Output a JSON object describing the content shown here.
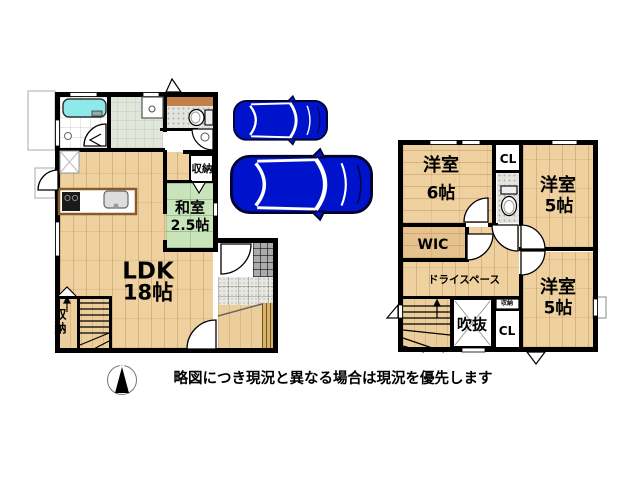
{
  "floor1": {
    "rooms": {
      "ldk": {
        "label": "LDK",
        "size": "18帖"
      },
      "washitsu": {
        "label": "和室",
        "size": "2.5帖"
      },
      "storage_east": {
        "label": "収納"
      },
      "storage_stairs": {
        "label": "収納"
      }
    }
  },
  "floor2": {
    "rooms": {
      "bedroom6": {
        "label": "洋室",
        "size": "6帖"
      },
      "bedroom5_north": {
        "label": "洋室",
        "size": "5帖"
      },
      "bedroom5_south": {
        "label": "洋室",
        "size": "5帖"
      },
      "wic": {
        "label": "WIC"
      },
      "dry_space": {
        "label": "ドライスペース"
      },
      "void": {
        "label": "吹抜"
      },
      "closet_north": {
        "label": "CL"
      },
      "closet_south": {
        "label": "CL"
      },
      "storage_small": {
        "label": "収納"
      }
    }
  },
  "compass": {
    "north": "N"
  },
  "caption": "略図につき現況と異なる場合は現況を優先します",
  "icons": {
    "car_small": "car-top-view-small",
    "car_large": "car-top-view-large",
    "compass": "compass-north-needle"
  },
  "palette": {
    "wall": "#000000",
    "wood": "#EFD1A0",
    "tatami": "#C9E4BB",
    "tub": "#8FE9EA",
    "car": "#0013CC",
    "sage": "#E0E6D9",
    "tile_dark": "#ABABAB"
  }
}
